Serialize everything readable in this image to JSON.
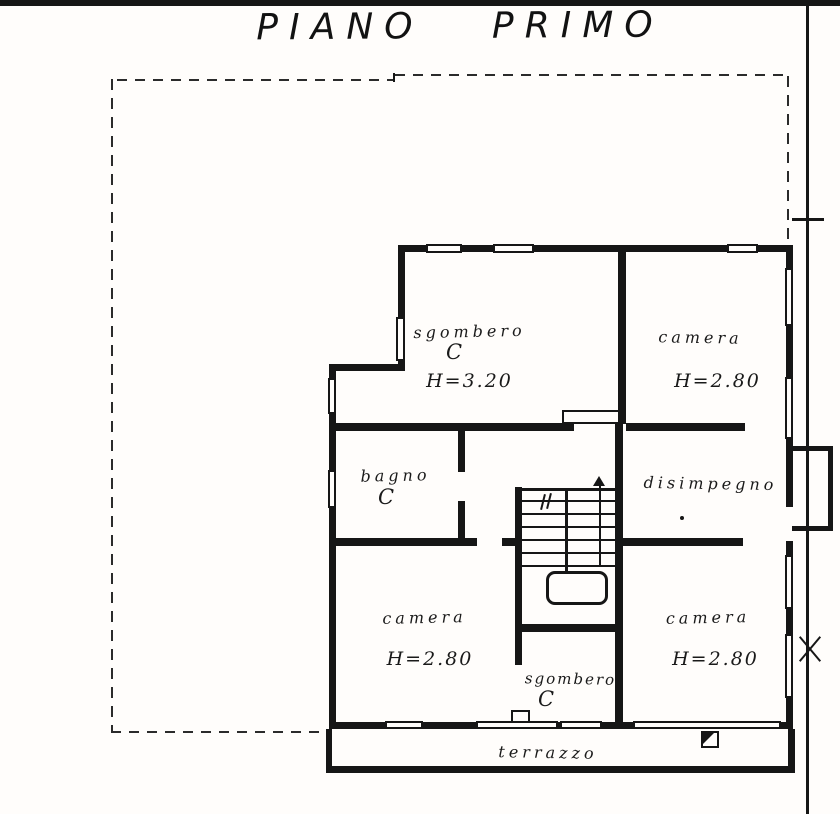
{
  "title": "PIANO PRIMO",
  "colors": {
    "ink": "#161616",
    "paper": "#ffffff"
  },
  "rooms": [
    {
      "label": "sgombero",
      "height": "H=3.20",
      "flourish": "C"
    },
    {
      "label": "camera",
      "height": "H=2.80"
    },
    {
      "label": "bagno",
      "flourish": "C"
    },
    {
      "label": "disimpegno"
    },
    {
      "label": "camera",
      "height": "H=2.80"
    },
    {
      "label": "sgombero",
      "flourish": "C"
    },
    {
      "label": "camera",
      "height": "H=2.80"
    },
    {
      "label": "terrazzo"
    }
  ]
}
